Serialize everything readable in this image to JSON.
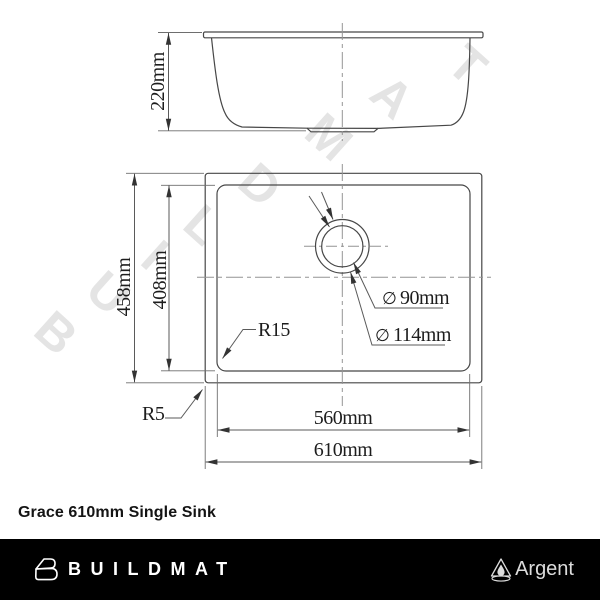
{
  "watermark": {
    "letters": [
      "B",
      "U",
      "I",
      "L",
      "D",
      "M",
      "A",
      "T"
    ]
  },
  "drawing": {
    "side_view": {
      "depth_label": "220mm"
    },
    "top_view": {
      "outer_height_label": "458mm",
      "bowl_height_label": "408mm",
      "bowl_width_label": "560mm",
      "outer_width_label": "610mm",
      "bowl_corner_radius_label": "R15",
      "outer_corner_radius_label": "R5",
      "drain": {
        "inner_diameter_symbol": "∅",
        "inner_diameter_label": "90mm",
        "outer_diameter_symbol": "∅",
        "outer_diameter_label": "114mm"
      }
    }
  },
  "caption": "Grace 610mm Single Sink",
  "footer": {
    "buildmat_wordmark": "BUILDMAT",
    "argent_wordmark": "Argent"
  },
  "colors": {
    "line": "#474747",
    "centerline": "#949494",
    "watermark": "#e4e4e4",
    "footer_bar": "#000000",
    "footer_text": "#ffffff",
    "argent_text": "#dcdcdc",
    "background": "#ffffff"
  }
}
